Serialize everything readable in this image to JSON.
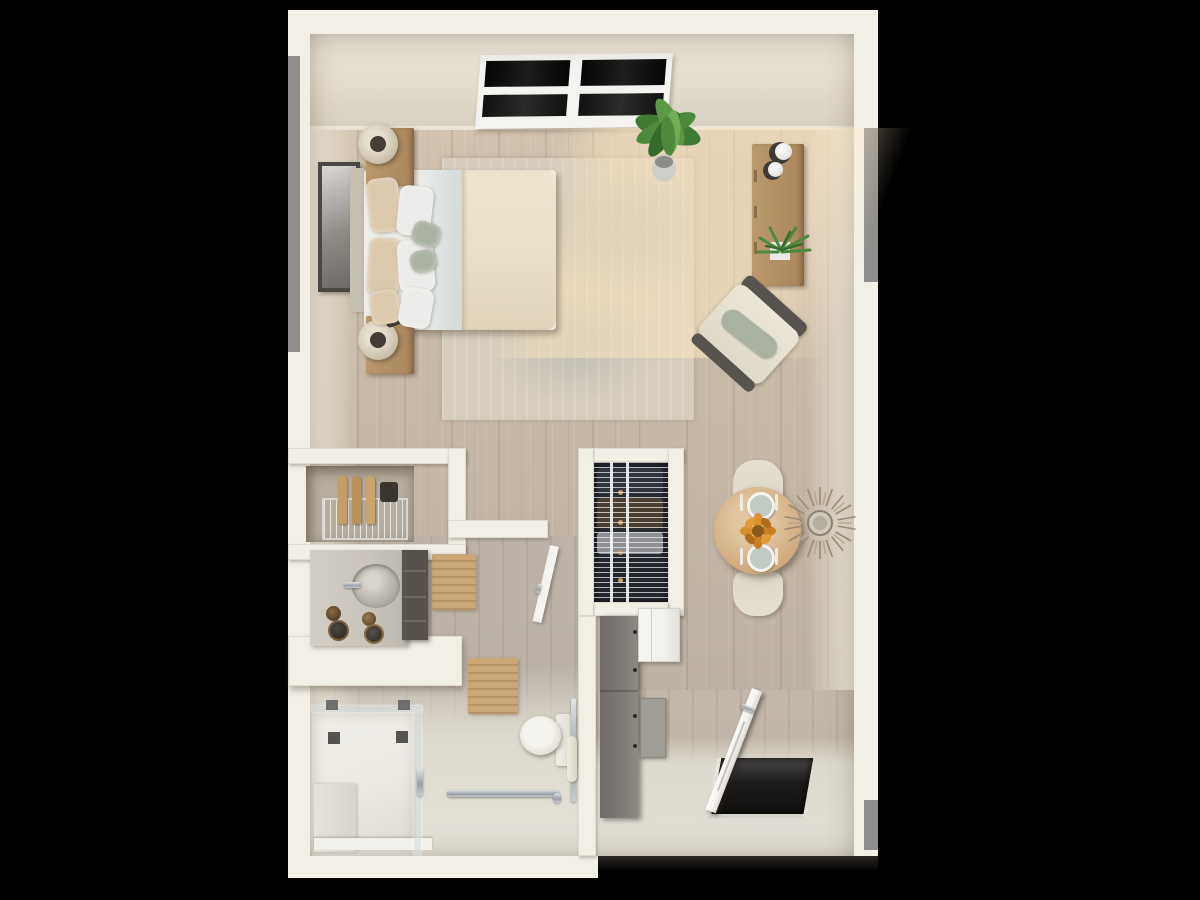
{
  "scene": {
    "type": "3d-rendered-floor-plan-top-view",
    "unit": "studio-apartment",
    "background": "letterboxed-black"
  },
  "palette": {
    "bg": "#000000",
    "wall": "#f2efe7",
    "wallFace": "#e9e2d5",
    "grayStrip": "#8f8e8c",
    "wood": "#c7b9a8",
    "bathTile": "#dedacf",
    "showerPan": "#eceae3",
    "glassEdge": "#d7dee0",
    "chrome": "#b7bcc0",
    "oak": "#bb9a6d",
    "oakDeep": "#a8865a",
    "darkCabinet": "#76726d",
    "appliance": "#f2f1ee",
    "linen": "#edece7",
    "duvet": "#e9dfcb",
    "sheet": "#dfe3e2",
    "pillowTan": "#dbc9ac",
    "sage": "#a9b1a2",
    "headboard": "#c6c0b3",
    "rug": "#d5ccbe",
    "rugShade": "#9aa5a3",
    "plantGreen": "#4d8a3c",
    "plantDark": "#356b2a",
    "flowerOrange": "#d78f2f",
    "flowerDeep": "#b06e1d",
    "closetDark": "#262a31",
    "clothesNavy": "#30343d",
    "clothesBrown": "#4a3e30",
    "clothesGray": "#8e9094",
    "artFrame": "#4a4745",
    "tableWood": "#cfab7d",
    "chairCream": "#ddd8c8",
    "nicheShadow": "#b6ad9f",
    "matTan": "#c9a876",
    "counterGray": "#c9c4bb",
    "drawerDark": "#57524d",
    "thresholdDark": "#121110",
    "doorWhite": "#f4f3f0",
    "mirrorTan": "#9a8c74"
  },
  "rooms": {
    "bedroom_living": {
      "items": [
        "window-2-panel",
        "framed-wall-art",
        "queen-bed",
        "headboard",
        "tan-pillows",
        "white-pillows",
        "sage-accent-pillows",
        "white-sheet",
        "cream-duvet",
        "nightstand-north",
        "table-lamp-north",
        "nightstand-south",
        "table-lamp-south",
        "distressed-area-rug",
        "floor-plant",
        "dresser-console",
        "decor-spheres",
        "aloe-planter",
        "accent-lounge-chair",
        "sunlight-patch"
      ]
    },
    "kitchenette": {
      "items": [
        "alcove-niche",
        "wire-basket-rack",
        "cutting-boards",
        "dark-canister"
      ]
    },
    "bathroom": {
      "items": [
        "vanity-counter",
        "oval-sink",
        "faucet",
        "toiletry-bottles",
        "drawer-cabinet",
        "wood-bath-mat-1",
        "wood-bath-mat-2",
        "pony-wall",
        "swing-door",
        "toilet",
        "vertical-grab-bar",
        "horizontal-grab-bar",
        "walk-in-shower",
        "glass-panel",
        "shower-heads",
        "shower-handle",
        "shower-curb"
      ]
    },
    "closet": {
      "items": [
        "wire-shelving",
        "hanging-clothes",
        "hanger-hooks"
      ]
    },
    "kitchen_hall": {
      "items": [
        "tall-cabinet-run",
        "refrigerator",
        "wall-oven-panel"
      ]
    },
    "dining": {
      "items": [
        "round-dining-table",
        "dining-chair-north",
        "dining-chair-south",
        "place-setting-north",
        "place-setting-south",
        "flower-centerpiece",
        "sunburst-wall-mirror"
      ]
    },
    "entry": {
      "items": [
        "entry-threshold",
        "open-entry-door",
        "door-handle"
      ]
    }
  }
}
